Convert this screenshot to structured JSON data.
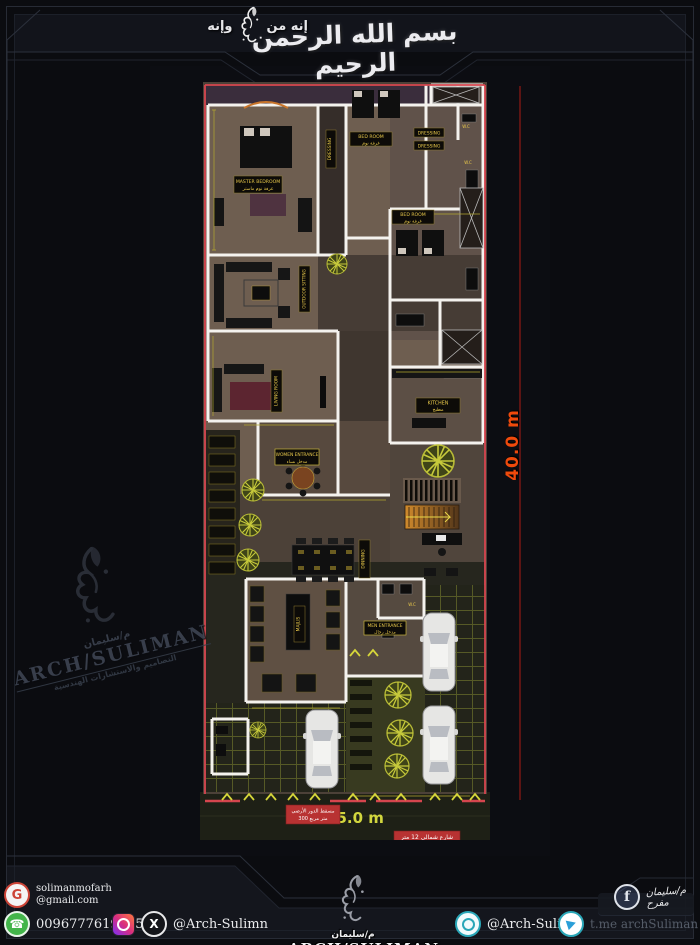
{
  "header": {
    "bismillah": "بسم الله الرحمن الرحيم",
    "tagline_right": "إنه من",
    "tagline_left": "وإنه"
  },
  "plan": {
    "dim_height": "40.0 m",
    "dim_width": "15.0 m",
    "notes": {
      "area_line1": "مسقط الدور الأرضي",
      "area_line2": "300 متر مربع",
      "street": "شارع شمالي 12 متر"
    },
    "rooms": {
      "master_en": "MASTER BEDROOM",
      "master_ar": "غرفة نوم ماستر",
      "bed_top_en": "BED ROOM",
      "bed_top_ar": "غرفة نوم",
      "bed_mid_en": "BED ROOM",
      "bed_mid_ar": "غرفة نوم",
      "dressing": "DRESSING",
      "outdoor_sitting": "OUTDOOR SITTING",
      "living": "LIVING ROOM",
      "kitchen_en": "KITCHEN",
      "kitchen_ar": "مطبخ",
      "women_en": "WOMEN ENTRANCE",
      "women_ar": "مدخل نساء",
      "dinning": "DINNING",
      "majlis": "MAJLIS",
      "men_en": "MEN ENTRANCE",
      "men_ar": "مدخل رجال",
      "wc": "W.C"
    }
  },
  "watermark": {
    "name_ar": "م/سليمان",
    "name_en": "ARCH/SULIMAN",
    "subtitle_ar": "التصاميم والاستشارات الهندسية"
  },
  "footer": {
    "email_user": "solimanmofarh",
    "email_domain": "@gmail.com",
    "phone": "00967776195453",
    "x_handle": "@Arch-Sulimn",
    "chat_handle": "@Arch-Sulimn",
    "telegram_handle": "t.me archSuliman",
    "fb_signature": "م/سليمان مفرح",
    "logo_ar": "م/سليمان",
    "logo_en": "ARCH/SULIMAN",
    "logo_sub": "التصاميم والاستشارات الهندسية"
  },
  "colors": {
    "accent_red": "#d5454e",
    "dim_orange": "#ef4a0c",
    "dim_yellow": "#b3a72f",
    "label_yellow": "#e8c84a"
  }
}
